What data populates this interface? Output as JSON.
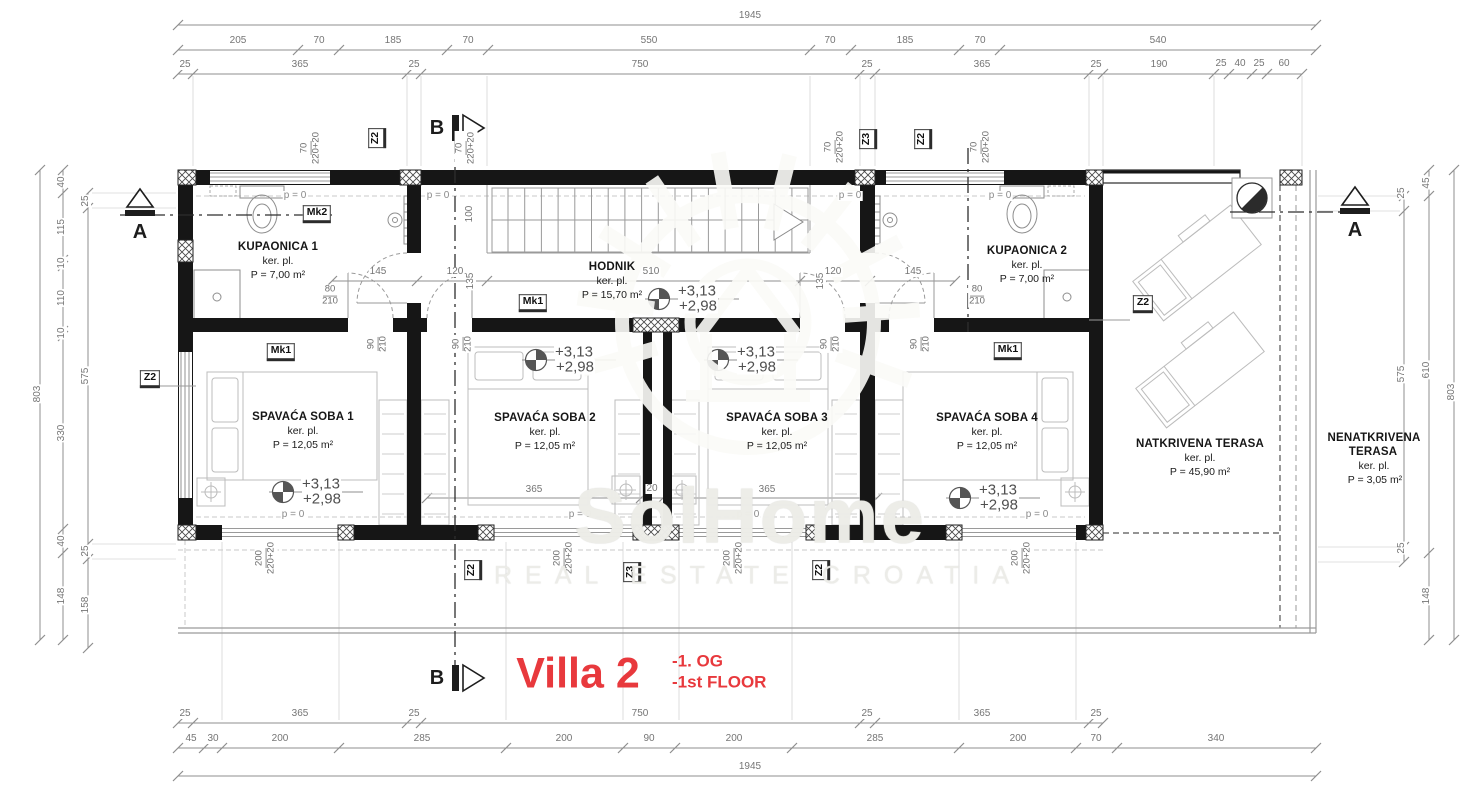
{
  "plan": {
    "rooms": {
      "kupaonica1": {
        "name": "KUPAONICA 1",
        "finish": "ker. pl.",
        "area": "P = 7,00 m²"
      },
      "hodnik": {
        "name": "HODNIK",
        "finish": "ker. pl.",
        "area": "P = 15,70 m²"
      },
      "kupaonica2": {
        "name": "KUPAONICA 2",
        "finish": "ker. pl.",
        "area": "P = 7,00 m²"
      },
      "soba1": {
        "name": "SPAVAĆA SOBA 1",
        "finish": "ker. pl.",
        "area": "P = 12,05 m²"
      },
      "soba2": {
        "name": "SPAVAĆA SOBA 2",
        "finish": "ker. pl.",
        "area": "P = 12,05 m²"
      },
      "soba3": {
        "name": "SPAVAĆA SOBA 3",
        "finish": "ker. pl.",
        "area": "P = 12,05 m²"
      },
      "soba4": {
        "name": "SPAVAĆA SOBA 4",
        "finish": "ker. pl.",
        "area": "P = 12,05 m²"
      },
      "natkrivena": {
        "name": "NATKRIVENA TERASA",
        "finish": "ker. pl.",
        "area": "P = 45,90 m²"
      },
      "nenatkrivena": {
        "name_line1": "NENATKRIVENA",
        "name_line2": "TERASA",
        "finish": "ker. pl.",
        "area": "P = 3,05 m²"
      }
    },
    "levels": {
      "upper": "+3,13",
      "lower": "+2,98",
      "zero": "p = 0"
    },
    "markers": {
      "section_a": "A",
      "section_b": "B",
      "mk1": "Mk1",
      "mk2": "Mk2",
      "z2": "Z2",
      "z3": "Z3"
    },
    "dims": {
      "top1": [
        "1945"
      ],
      "top2": [
        "205",
        "70",
        "185",
        "70",
        "550",
        "70",
        "185",
        "70",
        "540"
      ],
      "top3": [
        "25",
        "365",
        "25",
        "750",
        "25",
        "365",
        "25",
        "190",
        "25",
        "40",
        "25",
        "60"
      ],
      "bottom1": [
        "25",
        "365",
        "25",
        "750",
        "25",
        "365",
        "25"
      ],
      "bottom2": [
        "45",
        "30",
        "200",
        "285",
        "200",
        "90",
        "200",
        "285",
        "200",
        "70",
        "340"
      ],
      "bottom3": [
        "1945"
      ],
      "left_outer": [
        "803"
      ],
      "left_mid": [
        "40",
        "115",
        "10",
        "110",
        "10",
        "330",
        "40",
        "148"
      ],
      "left_inner": [
        "25",
        "575",
        "25",
        "158"
      ],
      "right_inner": [
        "25",
        "575",
        "25"
      ],
      "right_mid": [
        "45",
        "610",
        "148"
      ],
      "right_outer": [
        "803"
      ],
      "d145": "145",
      "d120": "120",
      "d510": "510",
      "d365": "365",
      "d20": "20",
      "d135": "135",
      "d100": "100",
      "fr80": {
        "w": "80",
        "h": "210"
      },
      "fr90": {
        "w": "90",
        "h": "210"
      },
      "fr70": {
        "w": "70",
        "h": "220+20"
      },
      "fr200": {
        "w": "200",
        "h": "220+20"
      }
    },
    "title": {
      "name": "Villa 2",
      "floor_de": "-1. OG",
      "floor_en": "-1st FLOOR",
      "accent_color": "#e8393d"
    },
    "watermark": {
      "brand": "SolHome",
      "tagline": "REAL ESTATE CROATIA"
    }
  }
}
